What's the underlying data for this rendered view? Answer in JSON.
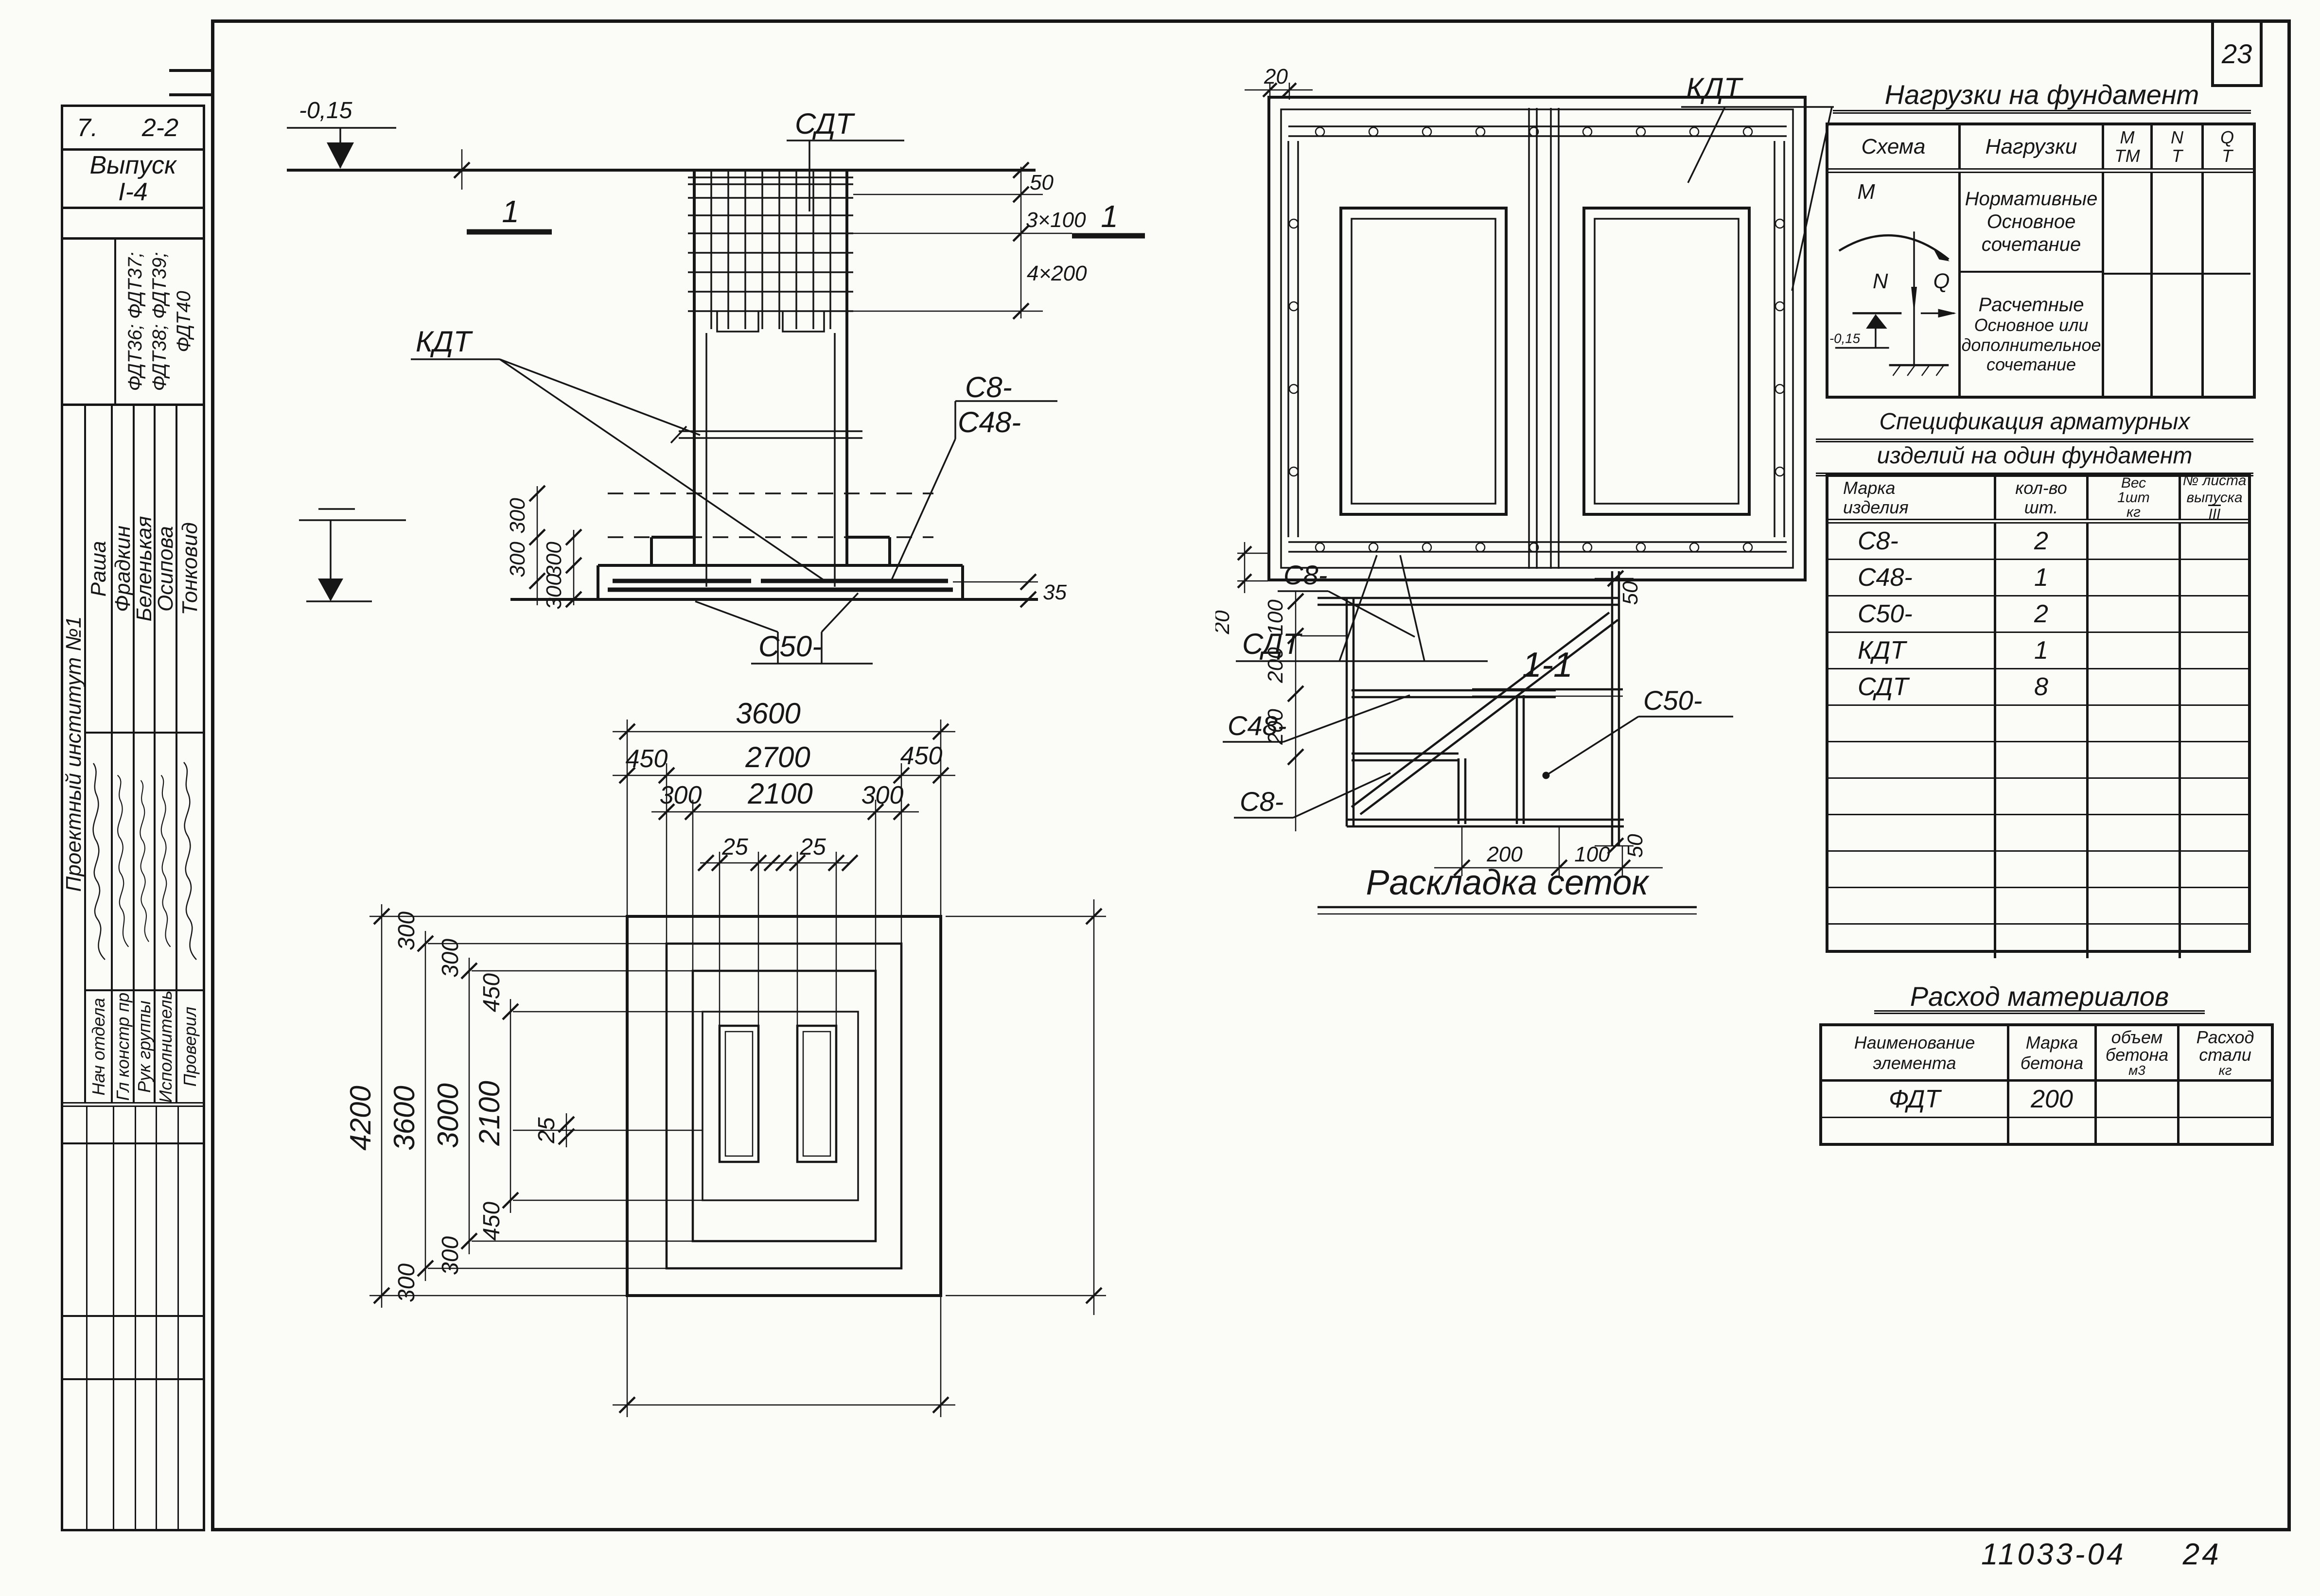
{
  "sheet": {
    "page_number": "23",
    "doc_number": "11033-04",
    "sheet_number": "24"
  },
  "title_block": {
    "row1_left": "7.",
    "row1_right": "2-2",
    "issue_line1": "Выпуск",
    "issue_line2": "I-4",
    "marks_line1": "ФДТ36; ФДТ37;",
    "marks_line2": "ФДТ38; ФДТ39;",
    "marks_line3": "ФДТ40",
    "org": "Проектный институт №1",
    "roles": [
      {
        "title": "Нач отдела",
        "name": "Раша"
      },
      {
        "title": "Гл констр пр",
        "name": "Фрадкин"
      },
      {
        "title": "Рук группы",
        "name": "Беленькая"
      },
      {
        "title": "Исполнитель",
        "name": "Осипова"
      },
      {
        "title": "Проверил",
        "name": "Тонковид"
      }
    ]
  },
  "elevation": {
    "level_top": "-0,15",
    "cut_mark": "1",
    "label_sdt": "СДТ",
    "label_kdt": "КДТ",
    "label_c8": "С8-",
    "label_c48": "С48-",
    "label_c50": "С50-",
    "dim_50": "50",
    "dim_3x100": "3×100",
    "dim_4x200": "4×200",
    "dim_35": "35",
    "dim_300": "300"
  },
  "section_1_1": {
    "title": "1-1",
    "label_kdt": "КДТ",
    "label_sdt": "СДТ",
    "dim_20": "20"
  },
  "mesh_layout": {
    "title": "Раскладка сеток",
    "label_c8_top": "С8-",
    "label_c48": "С48-",
    "label_c8_bottom": "С8-",
    "label_c50": "С50-",
    "dim_100": "100",
    "dim_200": "200",
    "dim_50": "50"
  },
  "plan": {
    "dim_3600": "3600",
    "dim_450": "450",
    "dim_2700": "2700",
    "dim_300": "300",
    "dim_2100": "2100",
    "dim_25": "25",
    "dim_4200": "4200",
    "dim_3000": "3000"
  },
  "loads": {
    "title": "Нагрузки на фундамент",
    "col_schema": "Схема",
    "col_loads": "Нагрузки",
    "col_m": "М",
    "col_m_unit": "ТМ",
    "col_n": "N",
    "col_n_unit": "Т",
    "col_q": "Q",
    "col_q_unit": "Т",
    "row_normative": [
      "Нормативные",
      "Основное",
      "сочетание"
    ],
    "row_design": [
      "Расчетные",
      "Основное или",
      "дополнительное",
      "сочетание"
    ],
    "scheme": {
      "m": "M",
      "n": "N",
      "q": "Q",
      "level": "-0,15"
    }
  },
  "spec": {
    "title_line1": "Спецификация арматурных",
    "title_line2": "изделий на один фундамент",
    "col_mark_l1": "Марка",
    "col_mark_l2": "изделия",
    "col_qty_l1": "кол-во",
    "col_qty_l2": "шт.",
    "col_weight_l1": "Вес",
    "col_weight_l2": "1шт",
    "col_weight_l3": "кг",
    "col_sheet_l1": "№ листа",
    "col_sheet_l2a": "выпуска",
    "col_sheet_l2b": "III",
    "rows": [
      {
        "mark": "С8-",
        "qty": "2",
        "weight": "",
        "sheet": ""
      },
      {
        "mark": "С48-",
        "qty": "1",
        "weight": "",
        "sheet": ""
      },
      {
        "mark": "С50-",
        "qty": "2",
        "weight": "",
        "sheet": ""
      },
      {
        "mark": "КДТ",
        "qty": "1",
        "weight": "",
        "sheet": ""
      },
      {
        "mark": "СДТ",
        "qty": "8",
        "weight": "",
        "sheet": ""
      },
      {
        "mark": "",
        "qty": "",
        "weight": "",
        "sheet": ""
      },
      {
        "mark": "",
        "qty": "",
        "weight": "",
        "sheet": ""
      },
      {
        "mark": "",
        "qty": "",
        "weight": "",
        "sheet": ""
      },
      {
        "mark": "",
        "qty": "",
        "weight": "",
        "sheet": ""
      },
      {
        "mark": "",
        "qty": "",
        "weight": "",
        "sheet": ""
      },
      {
        "mark": "",
        "qty": "",
        "weight": "",
        "sheet": ""
      },
      {
        "mark": "",
        "qty": "",
        "weight": "",
        "sheet": ""
      }
    ]
  },
  "materials": {
    "title": "Расход материалов",
    "col_name_l1": "Наименование",
    "col_name_l2": "элемента",
    "col_grade_l1": "Марка",
    "col_grade_l2": "бетона",
    "col_volume_l1": "объем",
    "col_volume_l2": "бетона",
    "col_volume_l3": "м3",
    "col_steel_l1": "Расход",
    "col_steel_l2": "стали",
    "col_steel_l3": "кг",
    "rows": [
      {
        "name": "ФДТ",
        "grade": "200",
        "volume": "",
        "steel": ""
      },
      {
        "name": "",
        "grade": "",
        "volume": "",
        "steel": ""
      }
    ]
  }
}
